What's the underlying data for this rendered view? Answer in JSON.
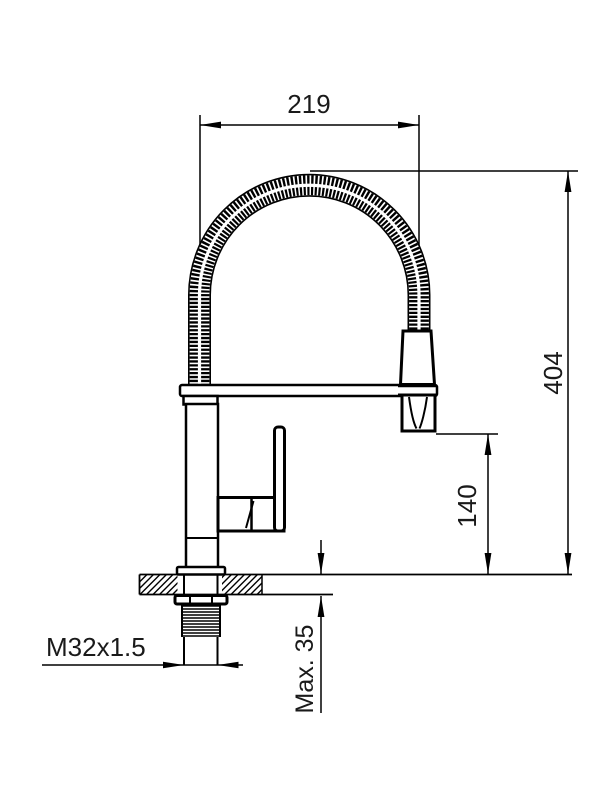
{
  "drawing": {
    "type": "technical-dimension-drawing",
    "subject": "kitchen faucet with flexible spring spout, side elevation",
    "labels": {
      "spout_width": "219",
      "total_height": "404",
      "outlet_height": "140",
      "deck_thickness": "Max. 35",
      "thread_size": "M32x1.5"
    },
    "colors": {
      "line": "#000000",
      "text": "#1a1a1a",
      "background": "#ffffff"
    }
  }
}
